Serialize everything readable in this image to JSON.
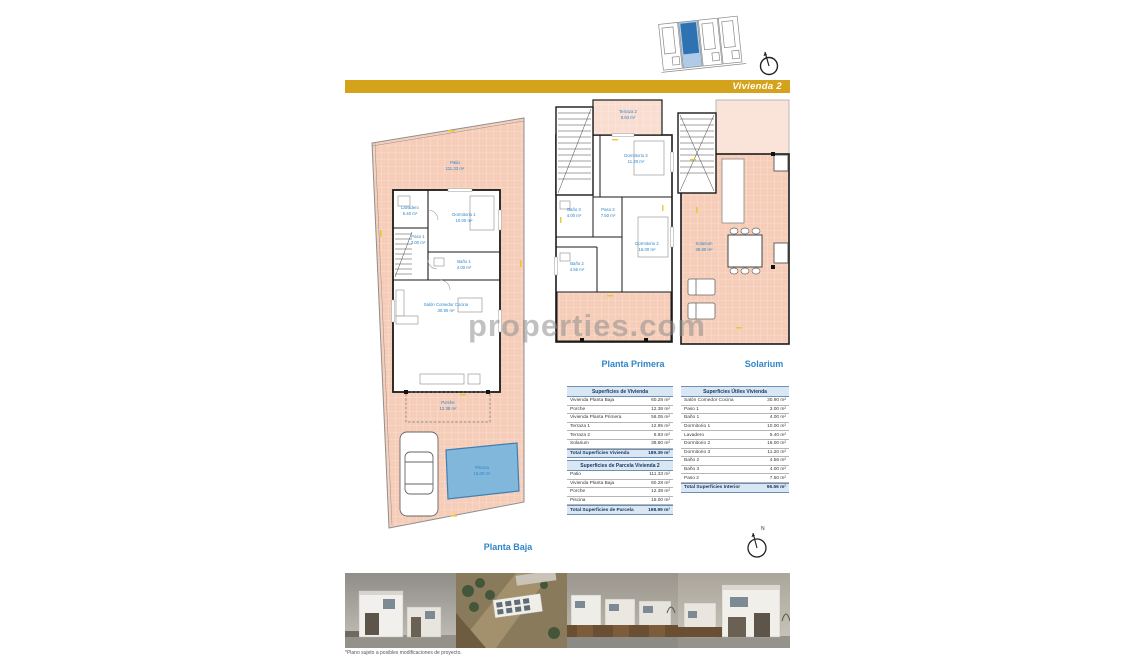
{
  "header": {
    "unit_label": "Vivienda 2",
    "accent_color": "#D5A21C",
    "site_plan_highlight": "#2F72B2"
  },
  "watermark_text": "properties.com",
  "compass": {
    "north_label": "N"
  },
  "plans": {
    "planta_baja": {
      "label": "Planta Baja",
      "rooms": [
        {
          "name": "Patio",
          "area": "111.33 m²"
        },
        {
          "name": "Lavadero",
          "area": "5.40 m²"
        },
        {
          "name": "Dormitorio 1",
          "area": "10.00 m²"
        },
        {
          "name": "Paso 1",
          "area": "3.00 m²"
        },
        {
          "name": "Baño 1",
          "area": "4.00 m²"
        },
        {
          "name": "Salón Comedor Cocina",
          "area": "30.90 m²"
        },
        {
          "name": "Porche",
          "area": "12.38 m²"
        },
        {
          "name": "Piscina",
          "area": "15.00 m²"
        }
      ]
    },
    "planta_primera": {
      "label": "Planta Primera",
      "rooms": [
        {
          "name": "Terraza 2",
          "area": "8.93 m²"
        },
        {
          "name": "Dormitorio 3",
          "area": "11.20 m²"
        },
        {
          "name": "Paso 2",
          "area": "7.50 m²"
        },
        {
          "name": "Baño 3",
          "area": "4.00 m²"
        },
        {
          "name": "Dormitorio 2",
          "area": "16.00 m²"
        },
        {
          "name": "Baño 2",
          "area": "4.56 m²"
        }
      ]
    },
    "solarium": {
      "label": "Solarium",
      "rooms": [
        {
          "name": "Solarium",
          "area": "38.80 m²"
        }
      ]
    }
  },
  "tables": {
    "vivienda": {
      "title": "Superficies de Vivienda",
      "rows": [
        [
          "Vivienda Planta Baja",
          "60.28 m²"
        ],
        [
          "Porche",
          "12.38 m²"
        ],
        [
          "Vivienda Planta Primera",
          "56.05 m²"
        ],
        [
          "Terraza 1",
          "12.95 m²"
        ],
        [
          "Terraza 2",
          "8.93 m²"
        ],
        [
          "Solarium",
          "38.80 m²"
        ]
      ],
      "total": [
        "Total Superficies Vivienda",
        "189.39 m²"
      ]
    },
    "parcela": {
      "title": "Superficies de Parcela Vivienda 2",
      "rows": [
        [
          "Patio",
          "111.33 m²"
        ],
        [
          "Vivienda Planta Baja",
          "60.28 m²"
        ],
        [
          "Porche",
          "12.38 m²"
        ],
        [
          "Piscina",
          "15.00 m²"
        ]
      ],
      "total": [
        "Total Superficies de Parcela",
        "198.99 m²"
      ]
    },
    "utiles": {
      "title": "Superficies Útiles Vivienda",
      "rows": [
        [
          "Salón Comedor Cocina",
          "30.90 m²"
        ],
        [
          "Paso 1",
          "3.00 m²"
        ],
        [
          "Baño 1",
          "4.00 m²"
        ],
        [
          "Dormitorio 1",
          "10.00 m²"
        ],
        [
          "Lavadero",
          "5.40 m²"
        ],
        [
          "Dormitorio 2",
          "16.00 m²"
        ],
        [
          "Dormitorio 3",
          "11.20 m²"
        ],
        [
          "Baño 2",
          "4.56 m²"
        ],
        [
          "Baño 3",
          "4.00 m²"
        ],
        [
          "Paso 2",
          "7.50 m²"
        ]
      ],
      "total": [
        "Total Superficies Interior",
        "96.56 m²"
      ]
    }
  },
  "footnote": "*Plano sujeto a posibles modificaciones de proyecto.",
  "colors": {
    "patio_fill": "#F6CDB8",
    "terrace_fill": "#F9DDD0",
    "pool_fill": "#82B7DC",
    "room_label_blue": "#2E86C8",
    "dimension_yellow": "#E8C832"
  }
}
